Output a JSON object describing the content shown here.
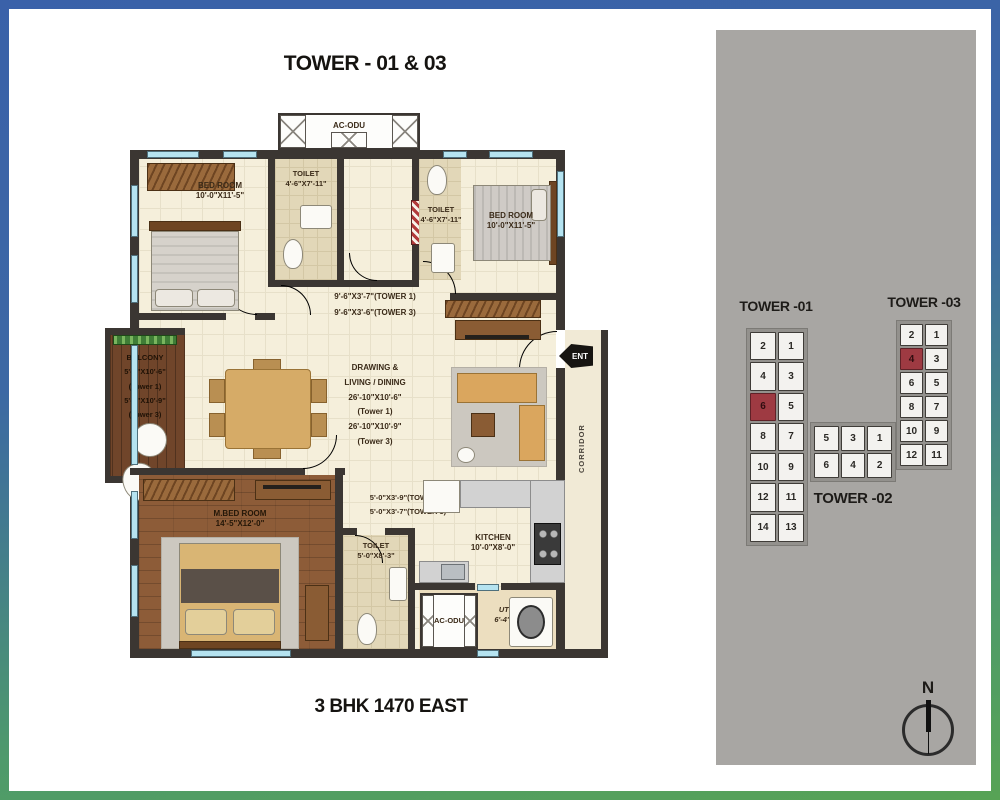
{
  "title": "TOWER - 01 & 03",
  "footer": "3 BHK 1470 EAST",
  "plan": {
    "ac_odu_top": "AC-ODU",
    "bedroom1": {
      "name": "BED ROOM",
      "dim": "10'-0\"X11'-5\""
    },
    "toilet_top_left": {
      "name": "TOILET",
      "dim": "4'-6\"X7'-11\""
    },
    "toilet_top_center": {
      "name": "TOILET",
      "dim": "4'-6\"X7'-11\""
    },
    "bedroom2": {
      "name": "BED ROOM",
      "dim": "10'-0\"X11'-5\""
    },
    "passage_top": {
      "line1": "9'-6\"X3'-7\"(TOWER 1)",
      "line2": "9'-6\"X3'-6\"(TOWER 3)"
    },
    "living": {
      "lines": [
        "DRAWING &",
        "LIVING / DINING",
        "26'-10\"X10'-6\"",
        "(Tower 1)",
        "26'-10\"X10'-9\"",
        "(Tower 3)"
      ]
    },
    "balcony": {
      "lines": [
        "BALCONY",
        "5'-5\"X10'-6\"",
        "(Tower 1)",
        "5'-5\"X10'-9\"",
        "(Tower 3)"
      ]
    },
    "entry_label": "ENT",
    "corridor_label": "CORRIDOR",
    "master_bedroom": {
      "name": "M.BED ROOM",
      "dim": "14'-5\"X12'-0\""
    },
    "passage_mid": {
      "line1": "5'-0\"X3'-9\"(TOWER 1)",
      "line2": "5'-0\"X3'-7\"(TOWER 3)"
    },
    "toilet_bottom": {
      "name": "TOILET",
      "dim": "5'-0\"X8'-3\""
    },
    "kitchen": {
      "name": "KITCHEN",
      "dim": "10'-0\"X8'-0\""
    },
    "utility": {
      "name": "UTILITY",
      "dim": "6'-4\"X4'-0\""
    },
    "ac_odu_bottom": "AC-ODU"
  },
  "keyplan": {
    "towers": [
      {
        "id": "tower-01",
        "label": "TOWER -01",
        "columns": 2,
        "units": [
          2,
          1,
          4,
          3,
          6,
          5,
          8,
          7,
          10,
          9,
          12,
          11,
          14,
          13
        ],
        "highlighted": [
          6
        ]
      },
      {
        "id": "tower-03",
        "label": "TOWER -03",
        "columns": 2,
        "units": [
          2,
          1,
          4,
          3,
          6,
          5,
          8,
          7,
          10,
          9,
          12,
          11
        ],
        "highlighted": [
          4
        ]
      },
      {
        "id": "tower-02",
        "label": "TOWER -02",
        "columns": 3,
        "units": [
          5,
          3,
          1,
          6,
          4,
          2
        ],
        "highlighted": []
      }
    ],
    "north_label": "N"
  },
  "colors": {
    "frame_blue": "#3a61a9",
    "frame_green": "#57a355",
    "panel_gray": "#a8a6a3",
    "wall": "#3b3632",
    "floor_cream": "#f5efdb",
    "wood_balcony": "#70452a",
    "wood_master": "#8d5c38",
    "window_cyan": "#b5e3f0",
    "highlight_red": "#9e3a42"
  }
}
